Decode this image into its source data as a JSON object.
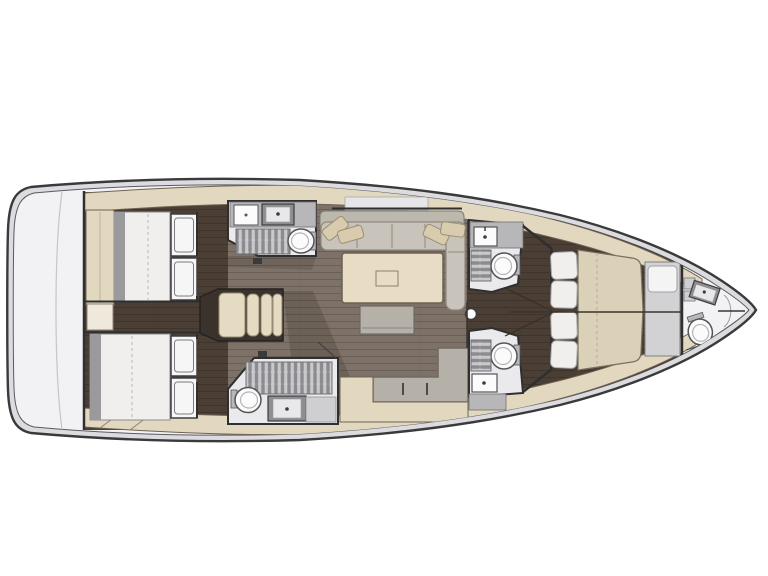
{
  "colors": {
    "page_bg": "#ffffff",
    "hull_outline": "#3a3a3a",
    "hull_band": "#dcdce0",
    "deck_white": "#f2f2f4",
    "band_beige": "#e2d8c0",
    "band_edge": "#6e6352",
    "room_white": "#eaeaec",
    "wall_dark": "#2f2f2f",
    "counter_grey": "#b7b7ba",
    "counter_light": "#cfcfd2",
    "fixture_white": "#fbfbfb",
    "fixture_stroke": "#555558",
    "sink_dark": "#8e8e92",
    "mattress_white": "#f0efee",
    "mattress_foot": "#9a9a9c",
    "mattress_seam": "#b9b7b4",
    "locker_white": "#f6f6f7",
    "sofa_grey": "#c8c4bb",
    "sofa_back": "#bcb8ae",
    "sofa_line": "#8f897d",
    "pillow_beige": "#d8cbae",
    "table_beige": "#e8ddc4",
    "bench_grey": "#b5b1a9",
    "bed_tan": "#dbd1b9",
    "steps_beige": "#e5dbc2",
    "floor_mid": "#7e7268",
    "floor_mid_line": "#6a5f56",
    "floor_dark": "#4b3e34",
    "floor_dark_line": "#3e342c",
    "grate_bg": "#c9c9cc",
    "grate_slat": "#8c8c90",
    "shadow": "rgba(35,28,22,0.20)"
  },
  "floorplan": {
    "type": "yacht-interior-floor-plan",
    "view": "top-down",
    "orientation": "bow-right-stern-left",
    "rooms": [
      {
        "name": "stern-deck",
        "features": []
      },
      {
        "name": "aft-cabin-starboard",
        "features": [
          "double-bed",
          "wardrobe",
          "stacked-lockers"
        ]
      },
      {
        "name": "aft-cabin-port",
        "features": [
          "double-bed",
          "stacked-lockers"
        ]
      },
      {
        "name": "aft-corridor",
        "features": [
          "storage-box"
        ]
      },
      {
        "name": "head-starboard-aft",
        "features": [
          "counter",
          "sink",
          "cabinet",
          "shower-grate",
          "toilet"
        ]
      },
      {
        "name": "head-port-aft",
        "features": [
          "shower-grate",
          "toilet",
          "sink",
          "counter"
        ]
      },
      {
        "name": "companionway",
        "features": [
          "steps"
        ]
      },
      {
        "name": "salon",
        "features": [
          "l-shaped-sofa",
          "throw-pillows",
          "table",
          "stool-bench",
          "settee",
          "sideboard",
          "mast-post"
        ]
      },
      {
        "name": "head-starboard-forward",
        "features": [
          "counter",
          "sink",
          "shower-grate",
          "toilet"
        ]
      },
      {
        "name": "head-port-forward",
        "features": [
          "toilet",
          "shower-grate",
          "sink",
          "counter"
        ]
      },
      {
        "name": "forward-cabin",
        "features": [
          "island-double-bed",
          "pillows",
          "foot-bench"
        ]
      },
      {
        "name": "bow-head",
        "features": [
          "shelves",
          "sink",
          "toilet"
        ]
      },
      {
        "name": "bow-locker",
        "features": []
      }
    ]
  }
}
